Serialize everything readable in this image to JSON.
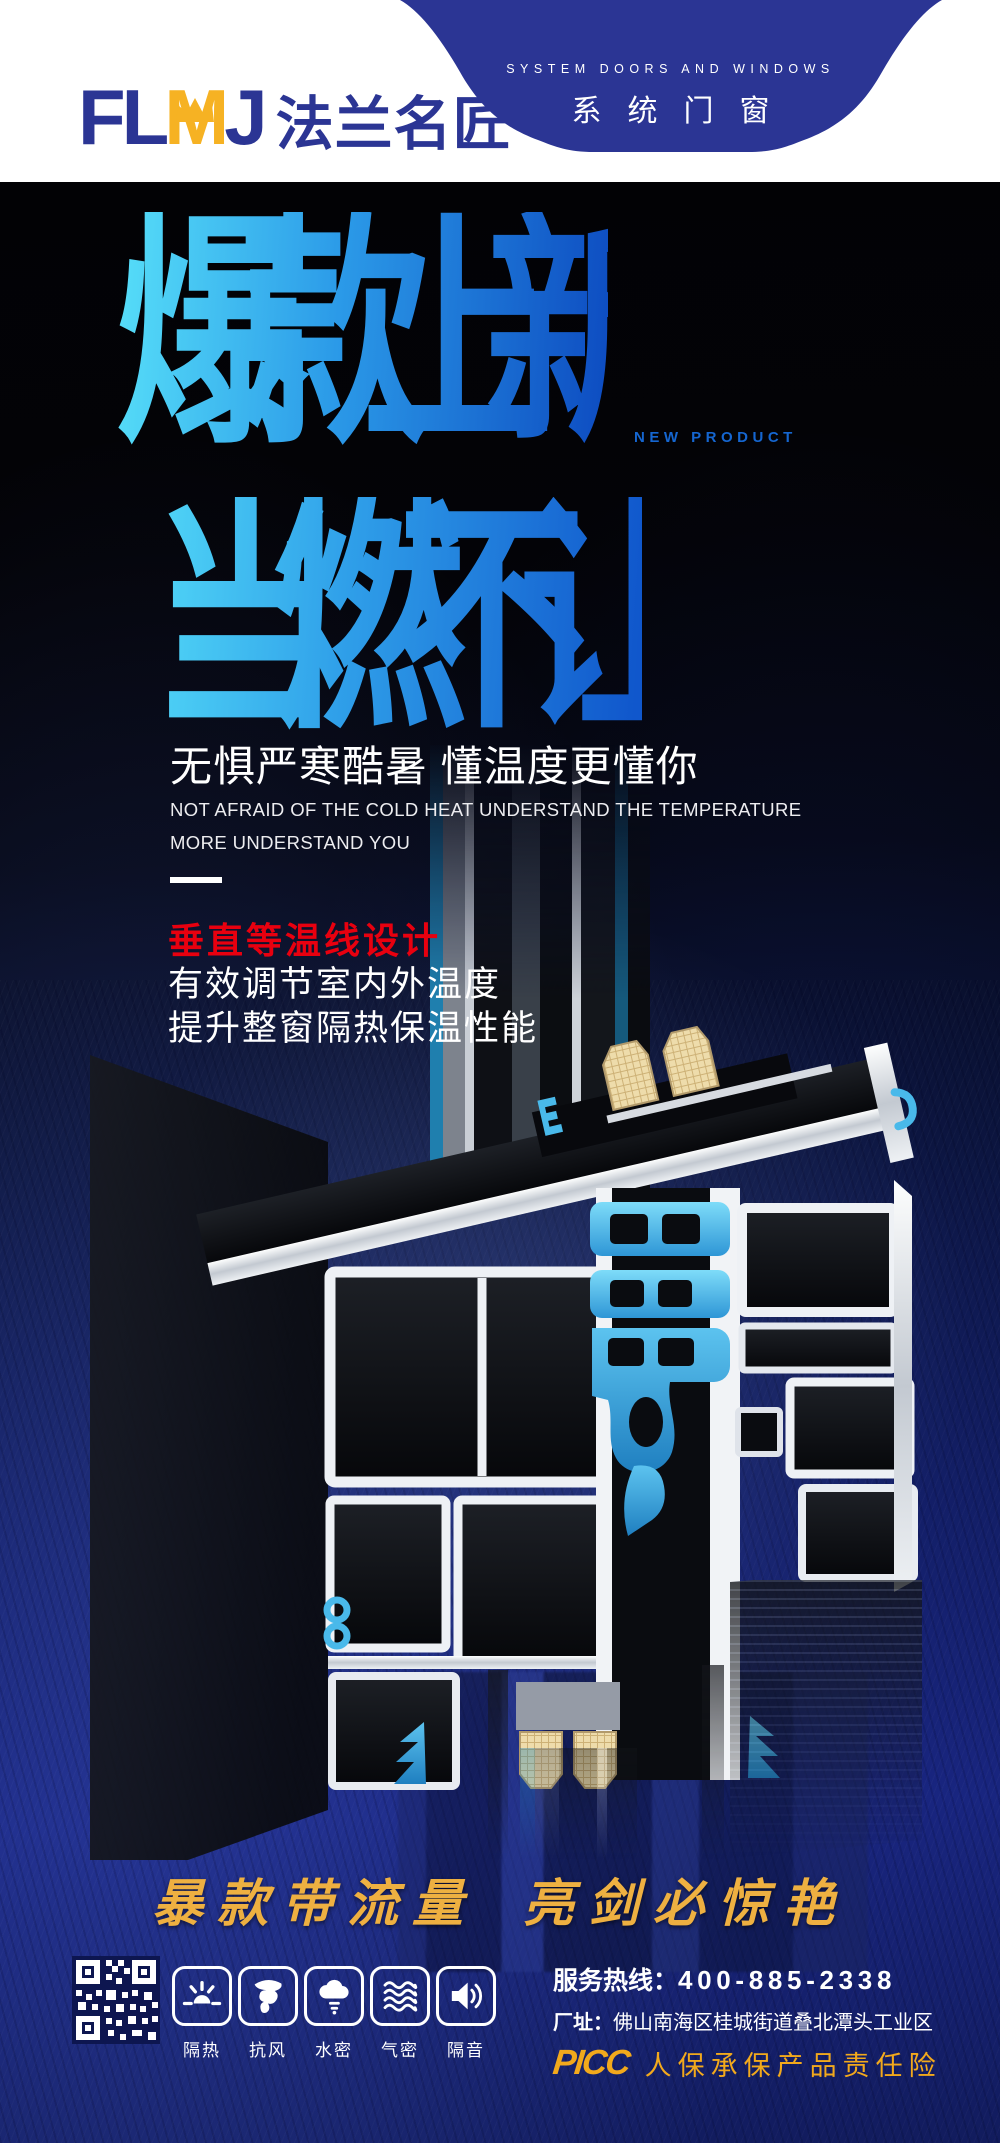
{
  "colors": {
    "brand_blue": "#2b3594",
    "logo_gold": "#f6b223",
    "title_gradient_start": "#55dcf8",
    "title_gradient_end": "#0e4ec2",
    "accent_red": "#e8000f",
    "slogan_gold": "#eeb041",
    "insurance_gold": "#f2a91c",
    "navy_background": "#18247e",
    "thermal_break_blue": "#49b9ea"
  },
  "header": {
    "logo_fl": "FL",
    "logo_m": "M",
    "logo_j": "J",
    "logo_cn": "法兰名匠",
    "badge_en": "SYSTEM DOORS AND WINDOWS",
    "badge_cn": "系统门窗"
  },
  "hero": {
    "title_line1": "爆款上新",
    "title_line2": "当燃不让",
    "new_product": "NEW PRODUCT",
    "subtitle": "无惧严寒酷暑 懂温度更懂你",
    "subtitle_en1": "NOT AFRAID OF THE COLD HEAT UNDERSTAND THE TEMPERATURE",
    "subtitle_en2": "MORE UNDERSTAND YOU"
  },
  "feature": {
    "heading": "垂直等温线设计",
    "line1": "有效调节室内外温度",
    "line2": "提升整窗隔热保温性能"
  },
  "slogan": {
    "left": "暴款带流量",
    "right": "亮剑必惊艳"
  },
  "footer": {
    "features": [
      {
        "icon": "sun-icon",
        "label": "隔热"
      },
      {
        "icon": "tornado-icon",
        "label": "抗风"
      },
      {
        "icon": "rain-icon",
        "label": "水密"
      },
      {
        "icon": "waves-icon",
        "label": "气密"
      },
      {
        "icon": "speaker-icon",
        "label": "隔音"
      }
    ],
    "hotline_label": "服务热线：",
    "hotline_number": "400-885-2338",
    "address_label": "厂址：",
    "address_value": "佛山南海区桂城街道叠北潭头工业区",
    "insurance_logo": "PICC",
    "insurance_text": "人保承保产品责任险"
  }
}
